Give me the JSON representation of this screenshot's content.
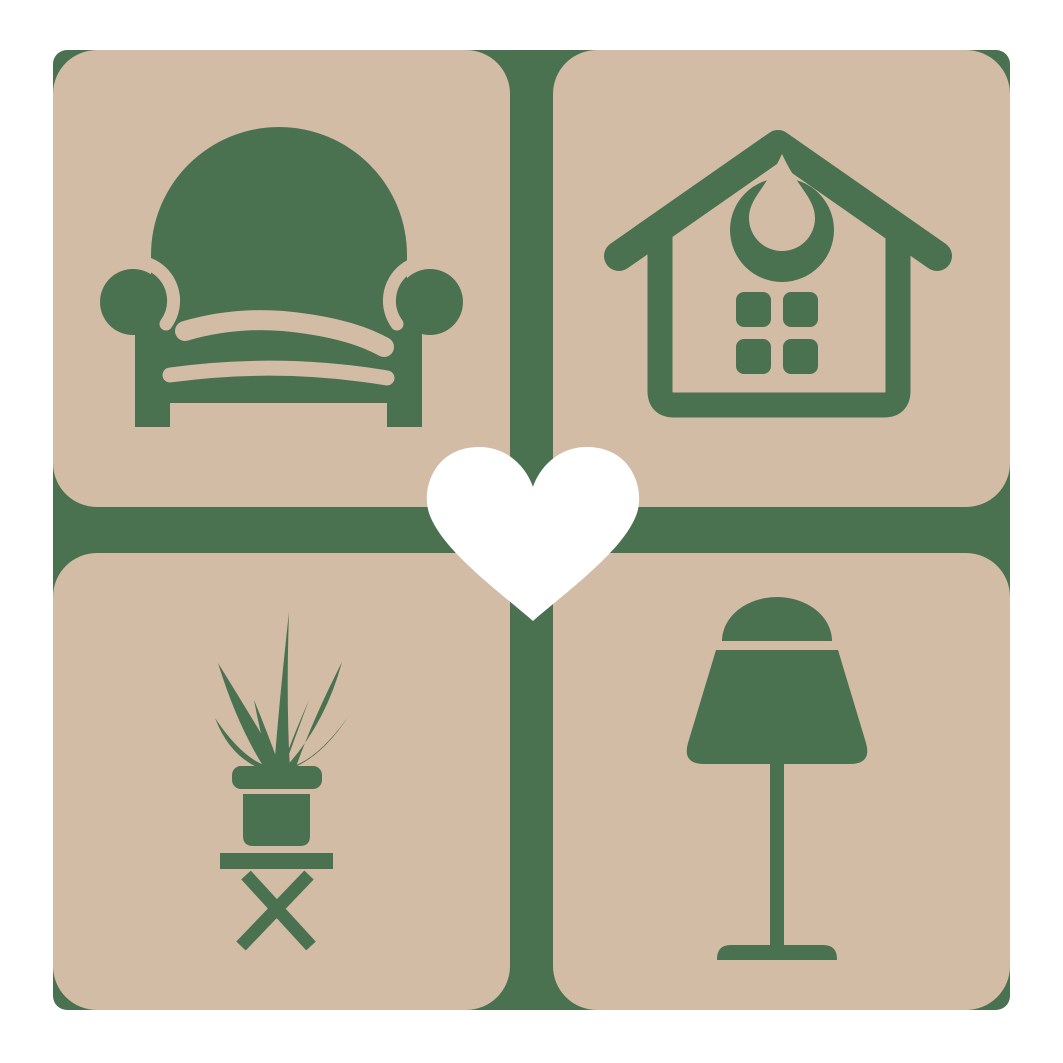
{
  "meta": {
    "type": "logo-graphic",
    "subject": "home-decor-furniture-logo",
    "grid": "2x2-rounded-tiles-with-center-heart"
  },
  "colors": {
    "background": "#ffffff",
    "backdrop_green": "#4a7250",
    "tile_tan": "#d3bca6",
    "icon_green": "#4a7250",
    "heart_white": "#ffffff"
  },
  "tiles": [
    {
      "position": "top-left",
      "icon": "armchair-icon"
    },
    {
      "position": "top-right",
      "icon": "house-icon"
    },
    {
      "position": "bottom-left",
      "icon": "potted-plant-icon"
    },
    {
      "position": "bottom-right",
      "icon": "table-lamp-icon"
    }
  ],
  "center_overlay": {
    "icon": "heart-icon"
  }
}
